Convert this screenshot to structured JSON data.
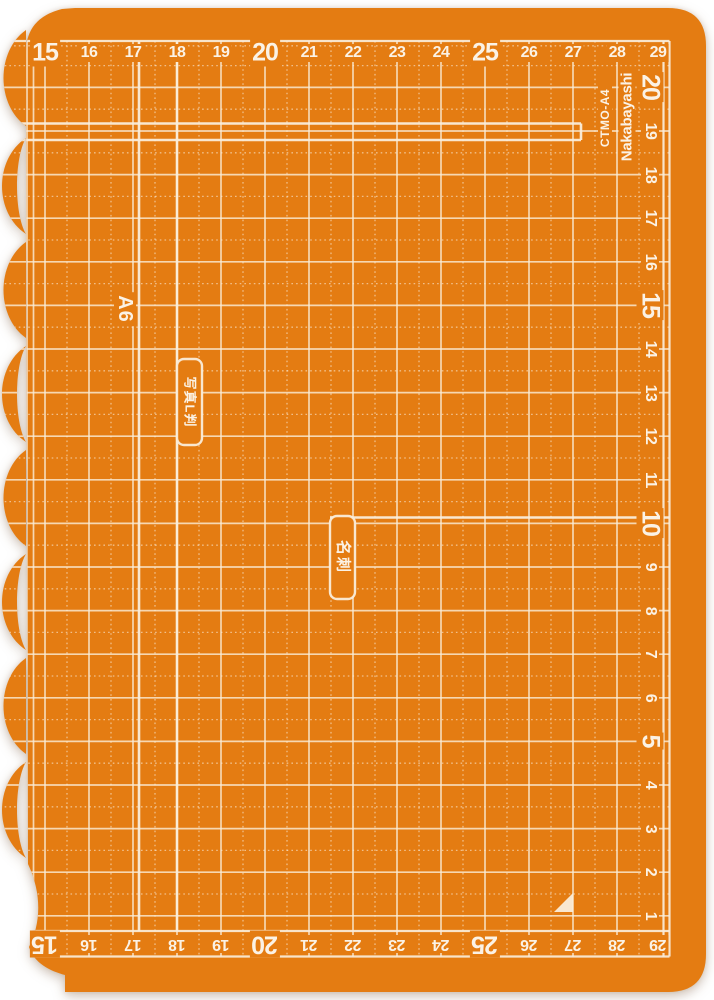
{
  "product": {
    "model": "CTMO-A4",
    "brand": "Nakabayashi"
  },
  "mat": {
    "labels": {
      "a6": "A6",
      "photo_l_size": "写真L判",
      "business_card": "名刺"
    },
    "rulers": {
      "top": [
        "15",
        "16",
        "17",
        "18",
        "19",
        "20",
        "21",
        "22",
        "23",
        "24",
        "25",
        "26",
        "27",
        "28",
        "29"
      ],
      "right": [
        "20",
        "19",
        "18",
        "17",
        "16",
        "15",
        "14",
        "13",
        "12",
        "11",
        "10",
        "9",
        "8",
        "7",
        "6",
        "5",
        "4",
        "3",
        "2",
        "1"
      ],
      "bottom": [
        "15",
        "16",
        "17",
        "18",
        "19",
        "20",
        "21",
        "22",
        "23",
        "24",
        "25",
        "26",
        "27",
        "28",
        "29"
      ]
    },
    "colors": {
      "mat_orange": "#E47C12",
      "grid_line": "#FAEDDA",
      "number_text": "#FBF2E5"
    }
  }
}
